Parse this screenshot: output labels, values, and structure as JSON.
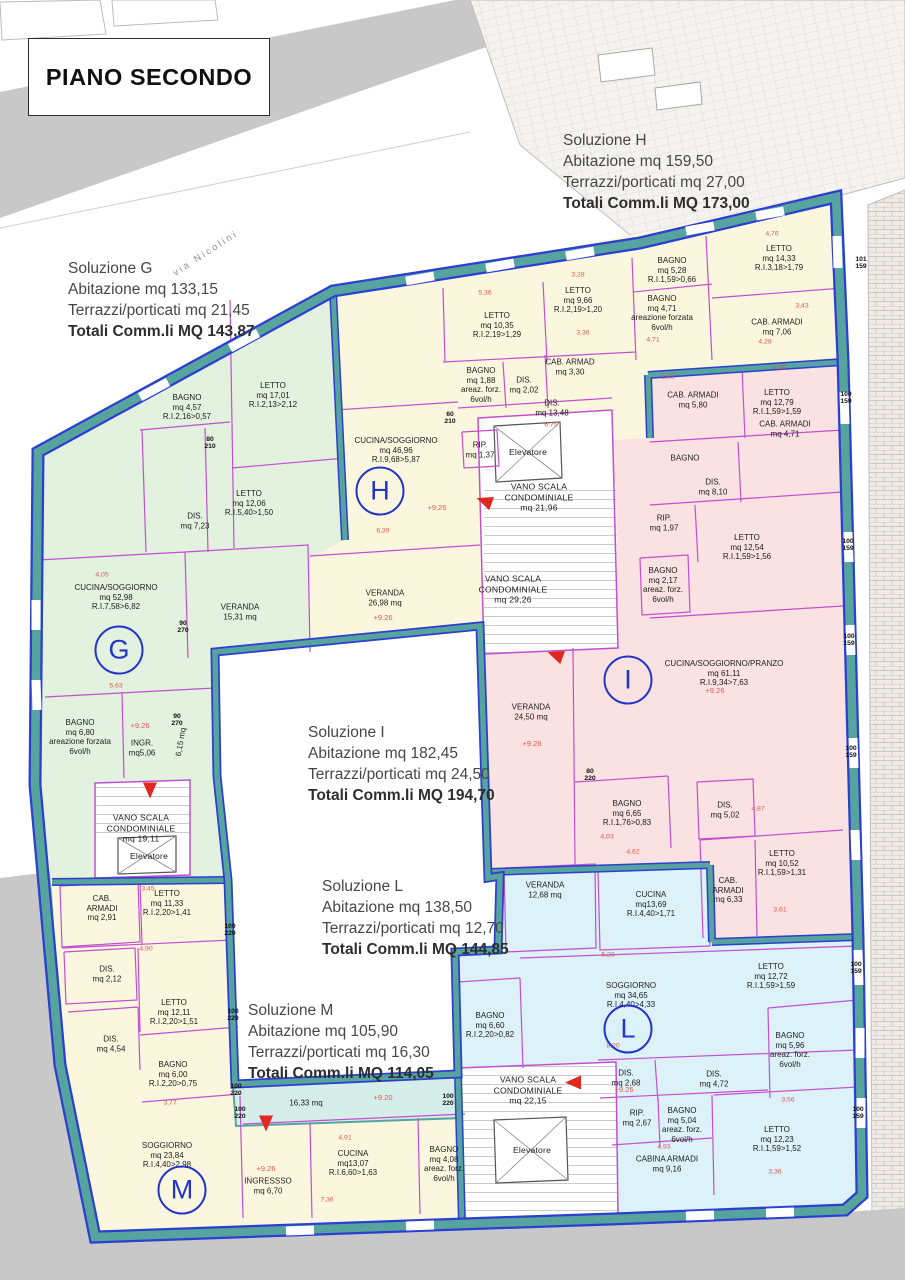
{
  "title": "PIANO SECONDO",
  "street": "via Nicolini",
  "colors": {
    "wall_teal": "#57a39d",
    "outline_blue": "#2b3fd1",
    "partition_magenta": "#c44ed0",
    "apartment_G": "#e2f2df",
    "apartment_H": "#fbf7df",
    "apartment_I": "#f9e2e1",
    "apartment_L": "#dcf1f8",
    "apartment_M": "#fbf7df",
    "terrace": "#d6eeea",
    "dimension_red": "#de5950",
    "badge_blue": "#2334cb",
    "road_gray": "#c8c8c8"
  },
  "solutions": [
    {
      "name": "Soluzione G",
      "abitazione": "Abitazione mq 133,15",
      "terrazzi": "Terrazzi/porticati mq 21,45",
      "totali": "Totali Comm.li MQ 143,87",
      "x": 68,
      "y": 258
    },
    {
      "name": "Soluzione H",
      "abitazione": "Abitazione mq 159,50",
      "terrazzi": "Terrazzi/porticati mq 27,00",
      "totali": "Totali Comm.li MQ 173,00",
      "x": 563,
      "y": 130
    },
    {
      "name": "Soluzione I",
      "abitazione": "Abitazione mq 182,45",
      "terrazzi": "Terrazzi/porticati mq 24,50",
      "totali": "Totali Comm.li MQ 194,70",
      "x": 308,
      "y": 722
    },
    {
      "name": "Soluzione L",
      "abitazione": "Abitazione mq 138,50",
      "terrazzi": "Terrazzi/porticati mq 12,70",
      "totali": "Totali Comm.li MQ 144,85",
      "x": 322,
      "y": 876
    },
    {
      "name": "Soluzione M",
      "abitazione": "Abitazione mq 105,90",
      "terrazzi": "Terrazzi/porticati mq 16,30",
      "totali": "Totali Comm.li MQ 114,05",
      "x": 248,
      "y": 1000
    }
  ],
  "badges": [
    {
      "letter": "G",
      "x": 119,
      "y": 650
    },
    {
      "letter": "H",
      "x": 380,
      "y": 491
    },
    {
      "letter": "I",
      "x": 628,
      "y": 680
    },
    {
      "letter": "L",
      "x": 628,
      "y": 1029
    },
    {
      "letter": "M",
      "x": 182,
      "y": 1190
    }
  ],
  "labels": [
    {
      "lines": [
        "BAGNO",
        "mq 4,57",
        "R.I.2,16>0,57"
      ],
      "x": 187,
      "y": 407
    },
    {
      "lines": [
        "LETTO",
        "mq 17,01",
        "R.I.2,13>2,12"
      ],
      "x": 273,
      "y": 395
    },
    {
      "lines": [
        "LETTO",
        "mq 12,06",
        "R.I.5,40>1,50"
      ],
      "x": 249,
      "y": 503
    },
    {
      "lines": [
        "DIS.",
        "mq 7,23"
      ],
      "x": 195,
      "y": 521
    },
    {
      "lines": [
        "CUCINA/SOGGIORNO",
        "mq 52,98",
        "R.I.7,58>6,82"
      ],
      "x": 116,
      "y": 597
    },
    {
      "lines": [
        "VERANDA",
        "15,31 mq"
      ],
      "x": 240,
      "y": 612
    },
    {
      "lines": [
        "BAGNO",
        "mq 6,80",
        "areazione forzata",
        "6vol/h"
      ],
      "x": 80,
      "y": 737
    },
    {
      "lines": [
        "INGR.",
        "mq5,06"
      ],
      "x": 142,
      "y": 748
    },
    {
      "lines": [
        "6,15 mq"
      ],
      "x": 181,
      "y": 742,
      "rot": -80
    },
    {
      "lines": [
        "VANO SCALA",
        "CONDOMINIALE",
        "mq 19,11"
      ],
      "x": 141,
      "y": 828,
      "cls": "st"
    },
    {
      "lines": [
        "Elevatore"
      ],
      "x": 149,
      "y": 856,
      "cls": "st"
    },
    {
      "lines": [
        "LETTO",
        "mq 10,35",
        "R.I.2,19>1,29"
      ],
      "x": 497,
      "y": 325
    },
    {
      "lines": [
        "LETTO",
        "mq 9,66",
        "R.I.2,19>1,20"
      ],
      "x": 578,
      "y": 300
    },
    {
      "lines": [
        "BAGNO",
        "mq 5,28",
        "R.I.1,59>0,66"
      ],
      "x": 672,
      "y": 270
    },
    {
      "lines": [
        "BAGNO",
        "mq 4,71",
        "areazione forzata",
        "6vol/h"
      ],
      "x": 662,
      "y": 313
    },
    {
      "lines": [
        "LETTO",
        "mq 14,33",
        "R.I.3,18>1,79"
      ],
      "x": 779,
      "y": 258
    },
    {
      "lines": [
        "CAB. ARMADI",
        "mq 7,06"
      ],
      "x": 777,
      "y": 327
    },
    {
      "lines": [
        "BAGNO",
        "mq 1,88",
        "areaz. forz.",
        "6vol/h"
      ],
      "x": 481,
      "y": 385
    },
    {
      "lines": [
        "DIS.",
        "mq 2,02"
      ],
      "x": 524,
      "y": 385
    },
    {
      "lines": [
        "CAB. ARMAD",
        "mq 3,30"
      ],
      "x": 570,
      "y": 367
    },
    {
      "lines": [
        "DIS.",
        "mq 13,48"
      ],
      "x": 552,
      "y": 408
    },
    {
      "lines": [
        "RIP.",
        "mq 1,37"
      ],
      "x": 480,
      "y": 450
    },
    {
      "lines": [
        "CUCINA/SOGGIORNO",
        "mq 46,96",
        "R.I.9,68>5,87"
      ],
      "x": 396,
      "y": 450
    },
    {
      "lines": [
        "VERANDA",
        "26,98 mq"
      ],
      "x": 385,
      "y": 598
    },
    {
      "lines": [
        "Elevatore"
      ],
      "x": 528,
      "y": 452,
      "cls": "st"
    },
    {
      "lines": [
        "VANO SCALA",
        "CONDOMINIALE",
        "mq 21,96"
      ],
      "x": 539,
      "y": 497,
      "cls": "st"
    },
    {
      "lines": [
        "VANO SCALA",
        "CONDOMINIALE",
        "mq 29,26"
      ],
      "x": 513,
      "y": 589,
      "cls": "st"
    },
    {
      "lines": [
        "CAB. ARMADI",
        "mq 5,80"
      ],
      "x": 693,
      "y": 400
    },
    {
      "lines": [
        "LETTO",
        "mq 12,79",
        "R.I.1,59>1,59"
      ],
      "x": 777,
      "y": 402
    },
    {
      "lines": [
        "BAGNO"
      ],
      "x": 685,
      "y": 458
    },
    {
      "lines": [
        "DIS.",
        "mq 8,10"
      ],
      "x": 713,
      "y": 487
    },
    {
      "lines": [
        "CAB. ARMADI",
        "mq 4,71"
      ],
      "x": 785,
      "y": 429
    },
    {
      "lines": [
        "RIP.",
        "mq 1,97"
      ],
      "x": 664,
      "y": 523
    },
    {
      "lines": [
        "LETTO",
        "mq 12,54",
        "R.I.1,59>1,56"
      ],
      "x": 747,
      "y": 547
    },
    {
      "lines": [
        "BAGNO",
        "mq 2,17",
        "areaz. forz.",
        "6vol/h"
      ],
      "x": 663,
      "y": 585
    },
    {
      "lines": [
        "CUCINA/SOGGIORNO/PRANZO",
        "mq 61,11",
        "R.I.9,34>7,63"
      ],
      "x": 724,
      "y": 673
    },
    {
      "lines": [
        "VERANDA",
        "24,50 mq"
      ],
      "x": 531,
      "y": 712
    },
    {
      "lines": [
        "BAGNO",
        "mq 6,65",
        "R.I.1,76>0,83"
      ],
      "x": 627,
      "y": 813
    },
    {
      "lines": [
        "DIS.",
        "mq 5,02"
      ],
      "x": 725,
      "y": 810
    },
    {
      "lines": [
        "LETTO",
        "mq 10,52",
        "R.I.1,59>1,31"
      ],
      "x": 782,
      "y": 863
    },
    {
      "lines": [
        "CAB.",
        "ARMADI",
        "mq 6,33"
      ],
      "x": 728,
      "y": 890
    },
    {
      "lines": [
        "VERANDA",
        "12,68 mq"
      ],
      "x": 545,
      "y": 890
    },
    {
      "lines": [
        "CUCINA",
        "mq13,69",
        "R.I.4,40>1,71"
      ],
      "x": 651,
      "y": 904
    },
    {
      "lines": [
        "SOGGIORNO",
        "mq 34,65",
        "R.I.4,40>4,33"
      ],
      "x": 631,
      "y": 995
    },
    {
      "lines": [
        "LETTO",
        "mq 12,72",
        "R.I.1,59>1,59"
      ],
      "x": 771,
      "y": 976
    },
    {
      "lines": [
        "BAGNO",
        "mq 6,60",
        "R.I.2,20>0,82"
      ],
      "x": 490,
      "y": 1025
    },
    {
      "lines": [
        "DIS.",
        "mq 2,68"
      ],
      "x": 626,
      "y": 1078
    },
    {
      "lines": [
        "DIS.",
        "mq 4,72"
      ],
      "x": 714,
      "y": 1079
    },
    {
      "lines": [
        "BAGNO",
        "mq 5,96",
        "areaz. forz.",
        "6vol/h"
      ],
      "x": 790,
      "y": 1050
    },
    {
      "lines": [
        "RIP.",
        "mq 2,67"
      ],
      "x": 637,
      "y": 1118
    },
    {
      "lines": [
        "BAGNO",
        "mq 5,04",
        "areaz. forz.",
        "6vol/h"
      ],
      "x": 682,
      "y": 1125
    },
    {
      "lines": [
        "CABINA ARMADI",
        "mq 9,16"
      ],
      "x": 667,
      "y": 1164
    },
    {
      "lines": [
        "LETTO",
        "mq 12,23",
        "R.I.1,59>1,52"
      ],
      "x": 777,
      "y": 1139
    },
    {
      "lines": [
        "VANO SCALA",
        "CONDOMINIALE",
        "mq 22,15"
      ],
      "x": 528,
      "y": 1090,
      "cls": "st"
    },
    {
      "lines": [
        "Elevatore"
      ],
      "x": 532,
      "y": 1150,
      "cls": "st"
    },
    {
      "lines": [
        "CAB.",
        "ARMADI",
        "mq 2,91"
      ],
      "x": 102,
      "y": 908
    },
    {
      "lines": [
        "LETTO",
        "mq 11,33",
        "R.I.2,20>1,41"
      ],
      "x": 167,
      "y": 903
    },
    {
      "lines": [
        "DIS.",
        "mq 2,12"
      ],
      "x": 107,
      "y": 974
    },
    {
      "lines": [
        "LETTO",
        "mq 12,11",
        "R.I.2,20>1,51"
      ],
      "x": 174,
      "y": 1012
    },
    {
      "lines": [
        "DIS.",
        "mq 4,54"
      ],
      "x": 111,
      "y": 1044
    },
    {
      "lines": [
        "BAGNO",
        "mq 6,00",
        "R.I.2,20>0,75"
      ],
      "x": 173,
      "y": 1074
    },
    {
      "lines": [
        "SOGGIORNO",
        "mq 23,84",
        "R.I.4,40>2,98"
      ],
      "x": 167,
      "y": 1155
    },
    {
      "lines": [
        "INGRESSSO",
        "mq 6,70"
      ],
      "x": 268,
      "y": 1186
    },
    {
      "lines": [
        "CUCINA",
        "mq13,07",
        "R.I.6,60>1,63"
      ],
      "x": 353,
      "y": 1163
    },
    {
      "lines": [
        "BAGNO",
        "mq 4,08",
        "areaz. forz.",
        "6vol/h"
      ],
      "x": 444,
      "y": 1164
    },
    {
      "lines": [
        "16,33 mq"
      ],
      "x": 306,
      "y": 1103
    }
  ],
  "levels": [
    {
      "t": "+9.26",
      "x": 140,
      "y": 726
    },
    {
      "t": "+9.26",
      "x": 437,
      "y": 508
    },
    {
      "t": "+9.26",
      "x": 383,
      "y": 618
    },
    {
      "t": "+9.26",
      "x": 715,
      "y": 691
    },
    {
      "t": "+9.26",
      "x": 532,
      "y": 744
    },
    {
      "t": "+9.26",
      "x": 624,
      "y": 1090
    },
    {
      "t": "+9.26",
      "x": 266,
      "y": 1169
    },
    {
      "t": "+9.20",
      "x": 383,
      "y": 1098
    }
  ],
  "dims": [
    {
      "t": "5,36",
      "x": 485,
      "y": 293
    },
    {
      "t": "3,28",
      "x": 578,
      "y": 275
    },
    {
      "t": "3,36",
      "x": 583,
      "y": 333
    },
    {
      "t": "4,76",
      "x": 772,
      "y": 234
    },
    {
      "t": "3,43",
      "x": 802,
      "y": 306
    },
    {
      "t": "4,28",
      "x": 765,
      "y": 342
    },
    {
      "t": "4,16",
      "x": 779,
      "y": 368
    },
    {
      "t": "2,63",
      "x": 668,
      "y": 377
    },
    {
      "t": "4,71",
      "x": 653,
      "y": 340
    },
    {
      "t": "4,93",
      "x": 664,
      "y": 1147
    },
    {
      "t": "3,56",
      "x": 788,
      "y": 1100
    },
    {
      "t": "3,36",
      "x": 775,
      "y": 1172
    },
    {
      "t": "6,75",
      "x": 551,
      "y": 425
    },
    {
      "t": "8,20",
      "x": 613,
      "y": 1046
    },
    {
      "t": "5,23",
      "x": 608,
      "y": 955
    },
    {
      "t": "6,39",
      "x": 383,
      "y": 531
    },
    {
      "t": "5,63",
      "x": 116,
      "y": 686
    },
    {
      "t": "4,05",
      "x": 102,
      "y": 575
    },
    {
      "t": "3,45",
      "x": 148,
      "y": 889
    },
    {
      "t": "4,90",
      "x": 146,
      "y": 949
    },
    {
      "t": "3,77",
      "x": 170,
      "y": 1103
    },
    {
      "t": "7,36",
      "x": 327,
      "y": 1200
    },
    {
      "t": "4,91",
      "x": 345,
      "y": 1138
    },
    {
      "t": "4,03",
      "x": 607,
      "y": 837
    },
    {
      "t": "4,62",
      "x": 633,
      "y": 852
    },
    {
      "t": "4,87",
      "x": 758,
      "y": 809
    },
    {
      "t": "3,61",
      "x": 780,
      "y": 910
    }
  ],
  "openings": [
    {
      "a": "101",
      "b": "159",
      "x": 861,
      "y": 263
    },
    {
      "a": "100",
      "b": "159",
      "x": 846,
      "y": 398
    },
    {
      "a": "100",
      "b": "159",
      "x": 848,
      "y": 545
    },
    {
      "a": "100",
      "b": "159",
      "x": 849,
      "y": 640
    },
    {
      "a": "100",
      "b": "159",
      "x": 851,
      "y": 752
    },
    {
      "a": "100",
      "b": "159",
      "x": 856,
      "y": 968
    },
    {
      "a": "100",
      "b": "159",
      "x": 858,
      "y": 1113
    },
    {
      "a": "100",
      "b": "220",
      "x": 230,
      "y": 930
    },
    {
      "a": "100",
      "b": "220",
      "x": 233,
      "y": 1015
    },
    {
      "a": "100",
      "b": "220",
      "x": 236,
      "y": 1090
    },
    {
      "a": "100",
      "b": "220",
      "x": 240,
      "y": 1113
    },
    {
      "a": "100",
      "b": "220",
      "x": 448,
      "y": 1100
    },
    {
      "a": "80",
      "b": "210",
      "x": 210,
      "y": 443
    },
    {
      "a": "60",
      "b": "210",
      "x": 450,
      "y": 418
    },
    {
      "a": "90",
      "b": "270",
      "x": 177,
      "y": 720
    },
    {
      "a": "90",
      "b": "270",
      "x": 183,
      "y": 627
    },
    {
      "a": "80",
      "b": "220",
      "x": 590,
      "y": 775
    }
  ],
  "arrows": [
    {
      "x": 486,
      "y": 504,
      "rot": 200
    },
    {
      "x": 557,
      "y": 658,
      "rot": 200
    },
    {
      "x": 575,
      "y": 1085,
      "rot": 180
    },
    {
      "x": 266,
      "y": 1124,
      "rot": 90
    },
    {
      "x": 150,
      "y": 791,
      "rot": 90
    }
  ]
}
